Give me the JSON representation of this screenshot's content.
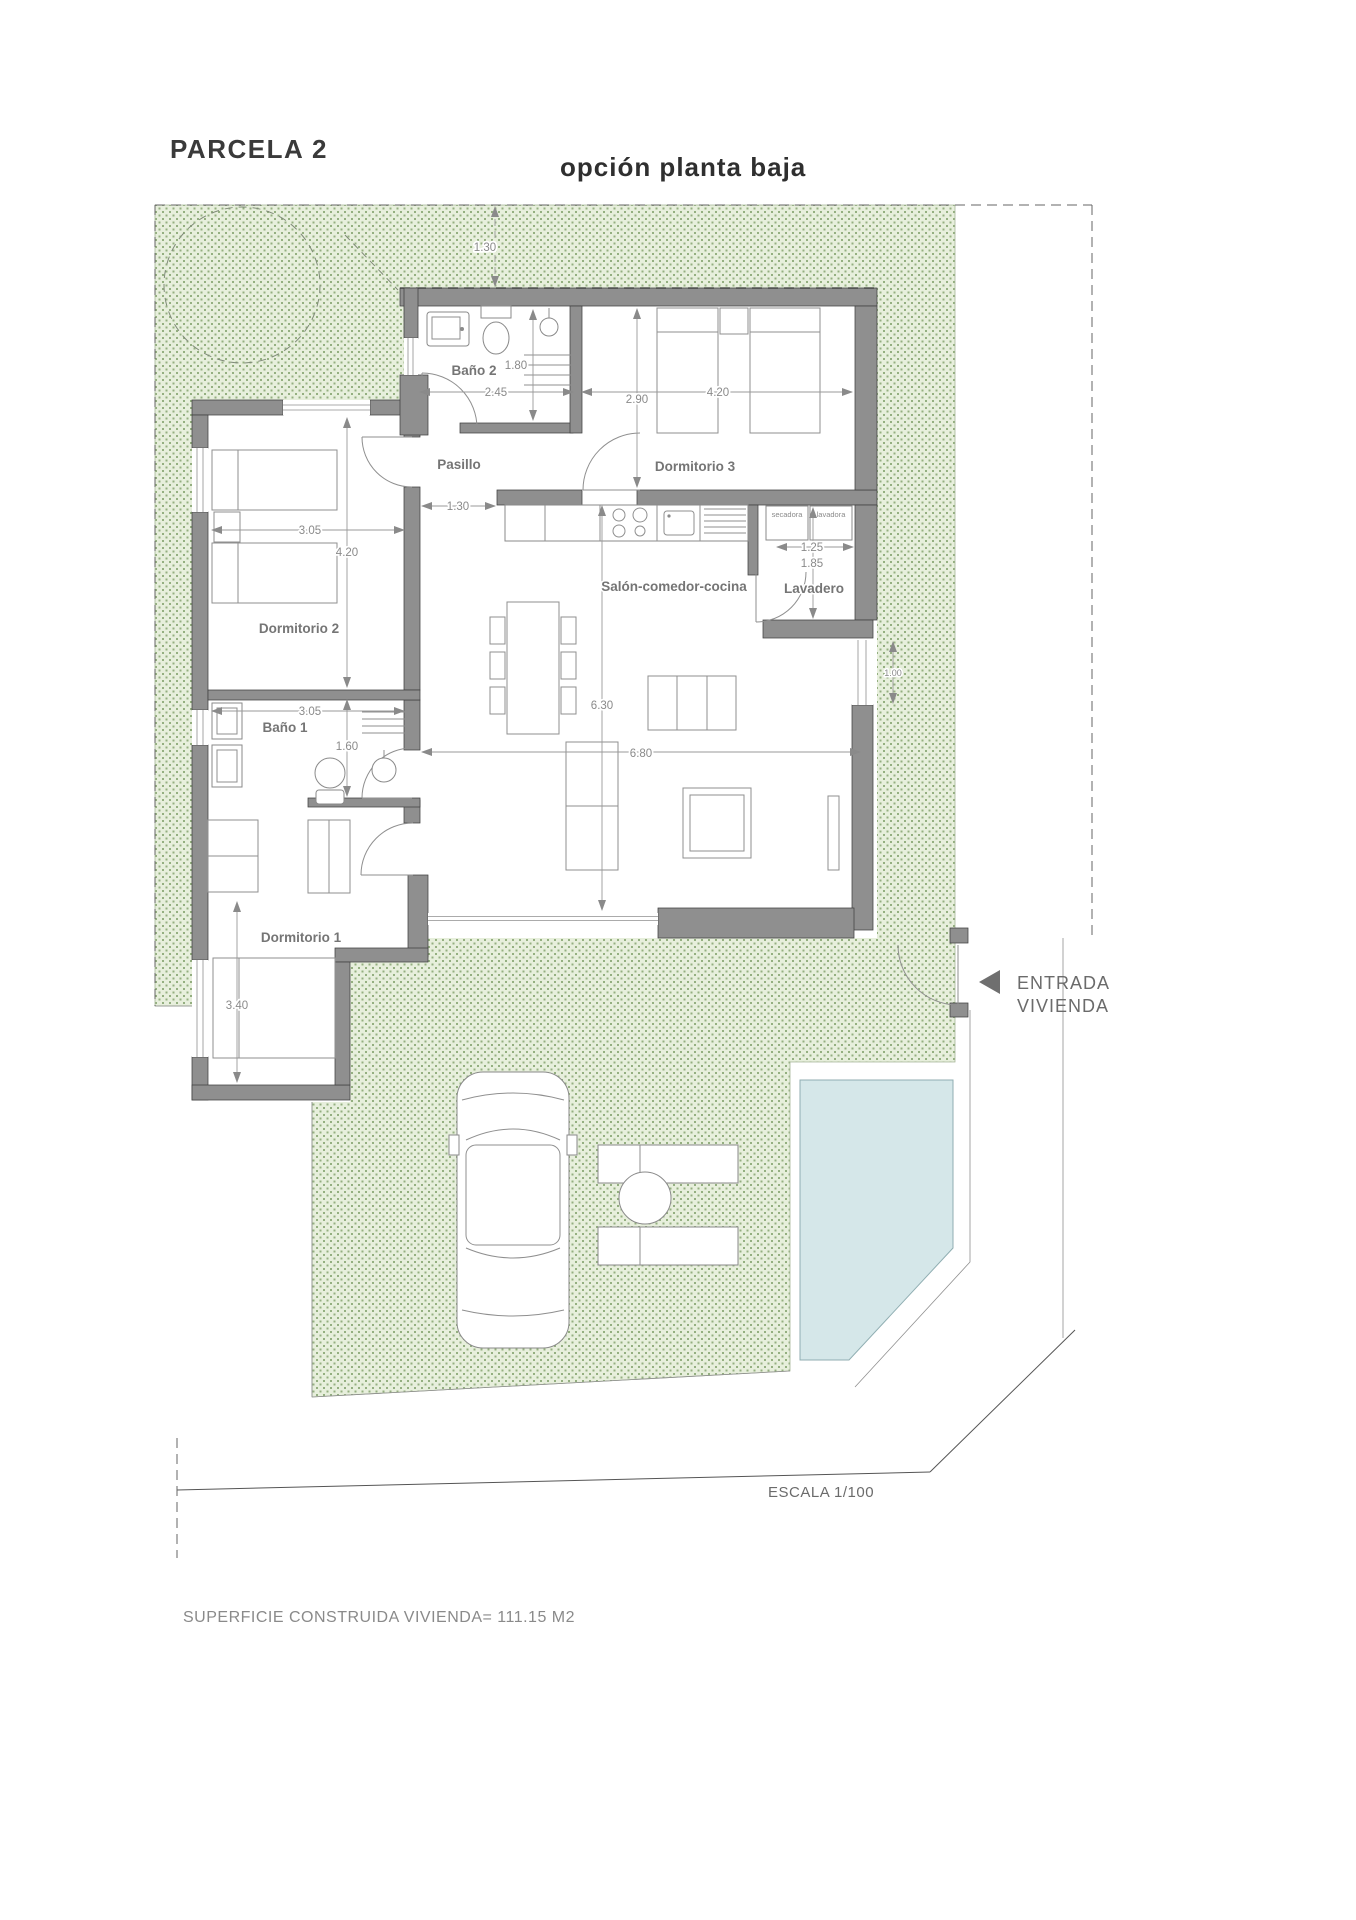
{
  "header": {
    "title": "PARCELA 2",
    "subtitle": "opción planta baja"
  },
  "rooms": {
    "bano2": "Baño 2",
    "pasillo": "Pasillo",
    "dormitorio3": "Dormitorio 3",
    "dormitorio2": "Dormitorio 2",
    "bano1": "Baño 1",
    "dormitorio1": "Dormitorio 1",
    "salon": "Salón-comedor-cocina",
    "lavadero": "Lavadero"
  },
  "appliances": {
    "dryer": "secadora",
    "washer": "lavadora"
  },
  "dims": {
    "setback_top": "1.30",
    "bano2_width": "2.45",
    "bano2_depth": "1.80",
    "dorm3_depth": "2.90",
    "dorm3_width": "4.20",
    "dorm2_width": "3.05",
    "dorm2_depth": "4.20",
    "hall_width": "1.30",
    "lavadero_width": "1.25",
    "lavadero_depth": "1.85",
    "salon_depth": "6.30",
    "salon_width": "6.80",
    "bano1_width": "3.05",
    "bano1_depth": "1.60",
    "dorm1_depth": "3.40",
    "east_window": "1.00"
  },
  "annotations": {
    "entrance_line1": "ENTRADA",
    "entrance_line2": "VIVIENDA",
    "scale": "ESCALA 1/100",
    "area": "SUPERFICIE CONSTRUIDA VIVIENDA= 111.15 M2"
  },
  "colors": {
    "garden_bg": "#e7efdc",
    "garden_dot": "#94af80",
    "wall": "#8f8f8f",
    "pool": "#d5e7e9",
    "dim_text": "#8a8a8a",
    "room_text": "#757575",
    "title_text": "#3a3a3a"
  }
}
